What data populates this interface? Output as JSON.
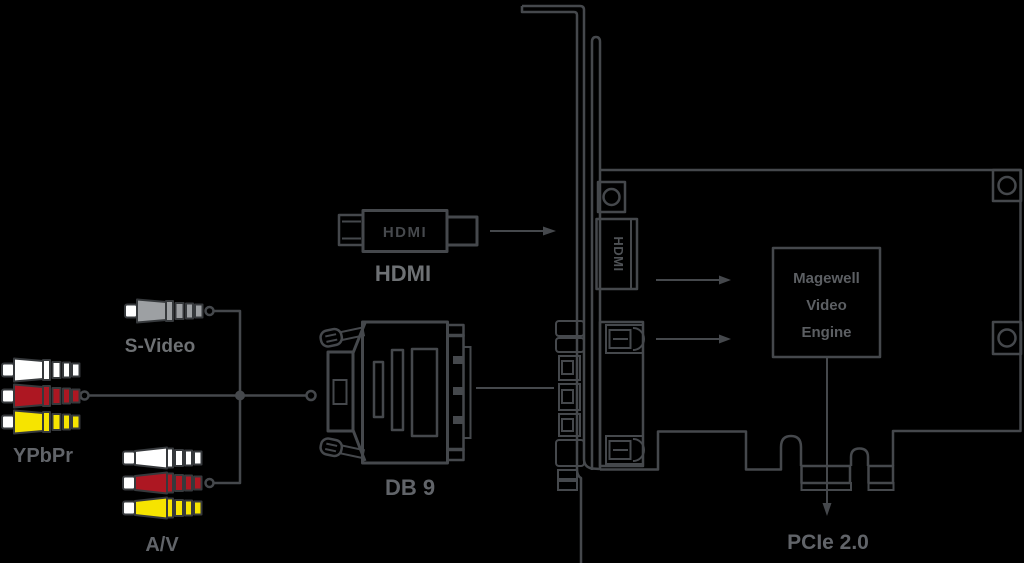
{
  "connectors": {
    "hdmi": {
      "label": "HDMI",
      "plug_text": "HDMI"
    },
    "db9": {
      "label": "DB 9"
    },
    "s_video": {
      "label": "S-Video"
    },
    "ypbpr": {
      "label": "YPbPr"
    },
    "av": {
      "label": "A/V"
    }
  },
  "card": {
    "port_label": "HDMI",
    "engine": {
      "line1": "Magewell",
      "line2": "Video",
      "line3": "Engine"
    },
    "bus_label": "PCIe 2.0"
  },
  "colors": {
    "background": "#000000",
    "line": "#45484c",
    "label": "#616469",
    "red": "#ad1722",
    "yellow": "#f6e400",
    "gray": "#9da0a3",
    "white": "#ffffff"
  }
}
